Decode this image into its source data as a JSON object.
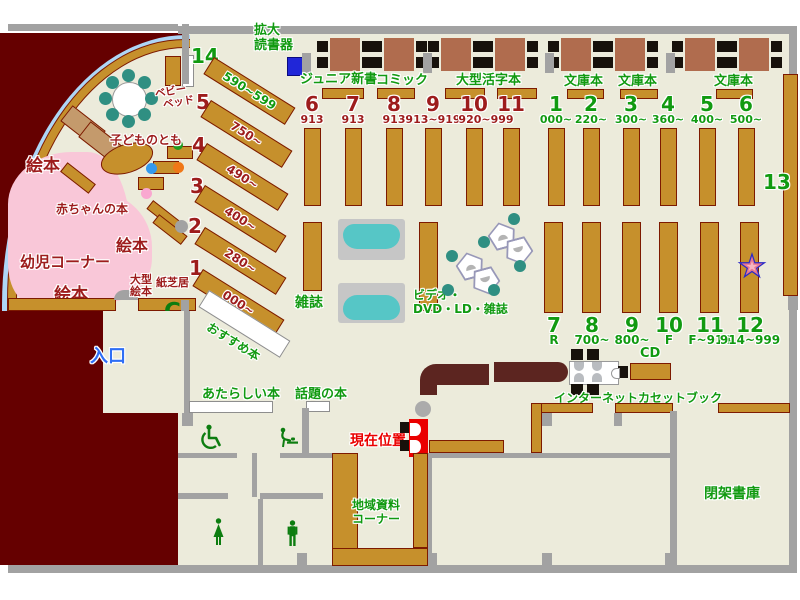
{
  "colors": {
    "floor": "#ecebdb",
    "wall": "#a2a2a2",
    "shelf_tan": "#c6902c",
    "shelf_border": "#7d1a00",
    "exterior_maroon": "#650000",
    "table_brown": "#b06c4e",
    "chair_black": "#17110b",
    "chair_teal": "#2f8f82",
    "kids_pink": "#f9c7d8",
    "window_blue": "#aed6f6",
    "text_green": "#119a11",
    "text_dark_red": "#9d1c1c",
    "entrance_blue": "#2e6ef5",
    "marker_red": "#ea0000",
    "magazine_teal": "#56c6c6",
    "star_pink": "#ef93a6",
    "star_blue": "#2a2ac8"
  },
  "entrance_label": "入口",
  "reader": {
    "l1": "拡大",
    "l2": "読書器"
  },
  "children": {
    "ehon_a": "絵本",
    "ehon_b": "絵本",
    "ehon_c": "絵本",
    "youji_corner": "幼児コーナー",
    "akachan": "赤ちゃんの本",
    "kodomo_no_tomo": "子どものとも",
    "baby_bed_l1": "ベビー",
    "baby_bed_l2": "ベッド",
    "oogata_l1": "大型",
    "oogata_l2": "絵本",
    "kamishibai": "紙芝居",
    "phone_glyph": "C"
  },
  "top_sections": [
    {
      "label": "ジュニア新書"
    },
    {
      "label": "コミック"
    },
    {
      "label": "大型活字本"
    },
    {
      "label": "文庫本"
    },
    {
      "label": "文庫本"
    },
    {
      "label": "文庫本"
    }
  ],
  "upper_stacks": [
    {
      "num": "6",
      "range": "913"
    },
    {
      "num": "7",
      "range": "913"
    },
    {
      "num": "8",
      "range": "913"
    },
    {
      "num": "9",
      "range": "913~919"
    },
    {
      "num": "10",
      "range": "920~999"
    },
    {
      "num": "11",
      "range": ""
    },
    {
      "num": "1",
      "range": "000~"
    },
    {
      "num": "2",
      "range": "220~"
    },
    {
      "num": "3",
      "range": "300~"
    },
    {
      "num": "4",
      "range": "360~"
    },
    {
      "num": "5",
      "range": "400~"
    },
    {
      "num": "6",
      "range": "500~"
    }
  ],
  "diag_shelves": [
    {
      "num": "14",
      "range": "590~599"
    },
    {
      "num": "5",
      "range": "750~"
    },
    {
      "num": "4",
      "range": "490~"
    },
    {
      "num": "3",
      "range": "400~"
    },
    {
      "num": "2",
      "range": "280~"
    },
    {
      "num": "1",
      "range": "000~"
    }
  ],
  "recommend_label": "おすすめ本",
  "zasshi_label": "雑誌",
  "video_label": {
    "l1": "ビデオ・",
    "l2": "DVD・LD・雑誌"
  },
  "lower_stacks": [
    {
      "num": "7",
      "range": "R"
    },
    {
      "num": "8",
      "range": "700~"
    },
    {
      "num": "9",
      "range": "800~"
    },
    {
      "num": "10",
      "range": "F"
    },
    {
      "num": "11",
      "range": "F~914"
    },
    {
      "num": "12",
      "range": "914~999"
    }
  ],
  "shelf13_label": "13",
  "services": {
    "internet": "インターネット",
    "cd": "CD",
    "cassette": "カセットブック"
  },
  "bottom_labels": {
    "atarashii": "あたらしい本",
    "wadai": "話題の本",
    "genzai": "現在位置",
    "chiiki_l1": "地域資料",
    "chiiki_l2": "コーナー",
    "heika": "閉架書庫"
  }
}
